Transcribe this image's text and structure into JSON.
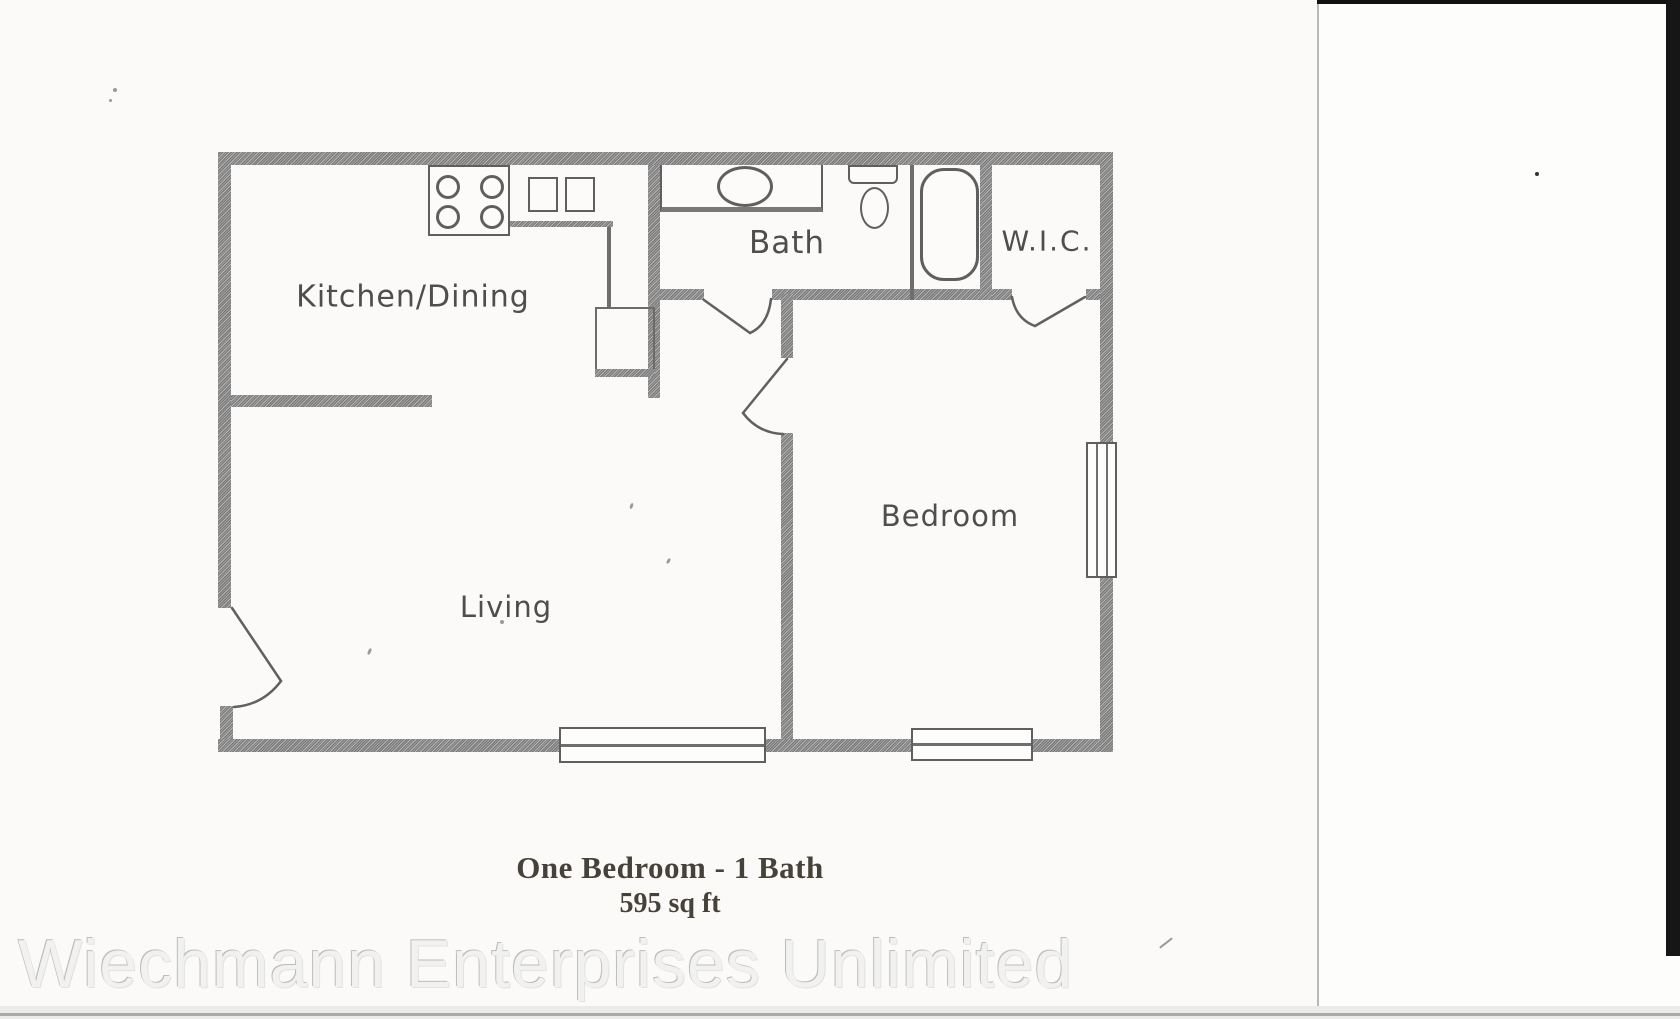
{
  "rooms": {
    "kitchen_dining": "Kitchen/Dining",
    "bath": "Bath",
    "wic": "W.I.C.",
    "bedroom": "Bedroom",
    "living": "Living"
  },
  "caption": {
    "title": "One Bedroom - 1 Bath",
    "area": "595 sq ft"
  },
  "watermark": "Wiechmann Enterprises Unlimited",
  "fixtures": {
    "stove": "stove-icon",
    "kitchen_sink": "double-sink-icon",
    "bathroom_vanity": "vanity-sink-icon",
    "toilet": "toilet-icon",
    "bathtub": "bathtub-icon",
    "window": "window-icon",
    "door": "door-swing-icon"
  },
  "colors": {
    "wall": "#8d8d8d",
    "fixture_line": "#5f5f5f",
    "label_text": "#4e4e4e",
    "caption_text": "#454239",
    "watermark_fill": "#f1f1f0",
    "paper": "#fbfaf8"
  }
}
